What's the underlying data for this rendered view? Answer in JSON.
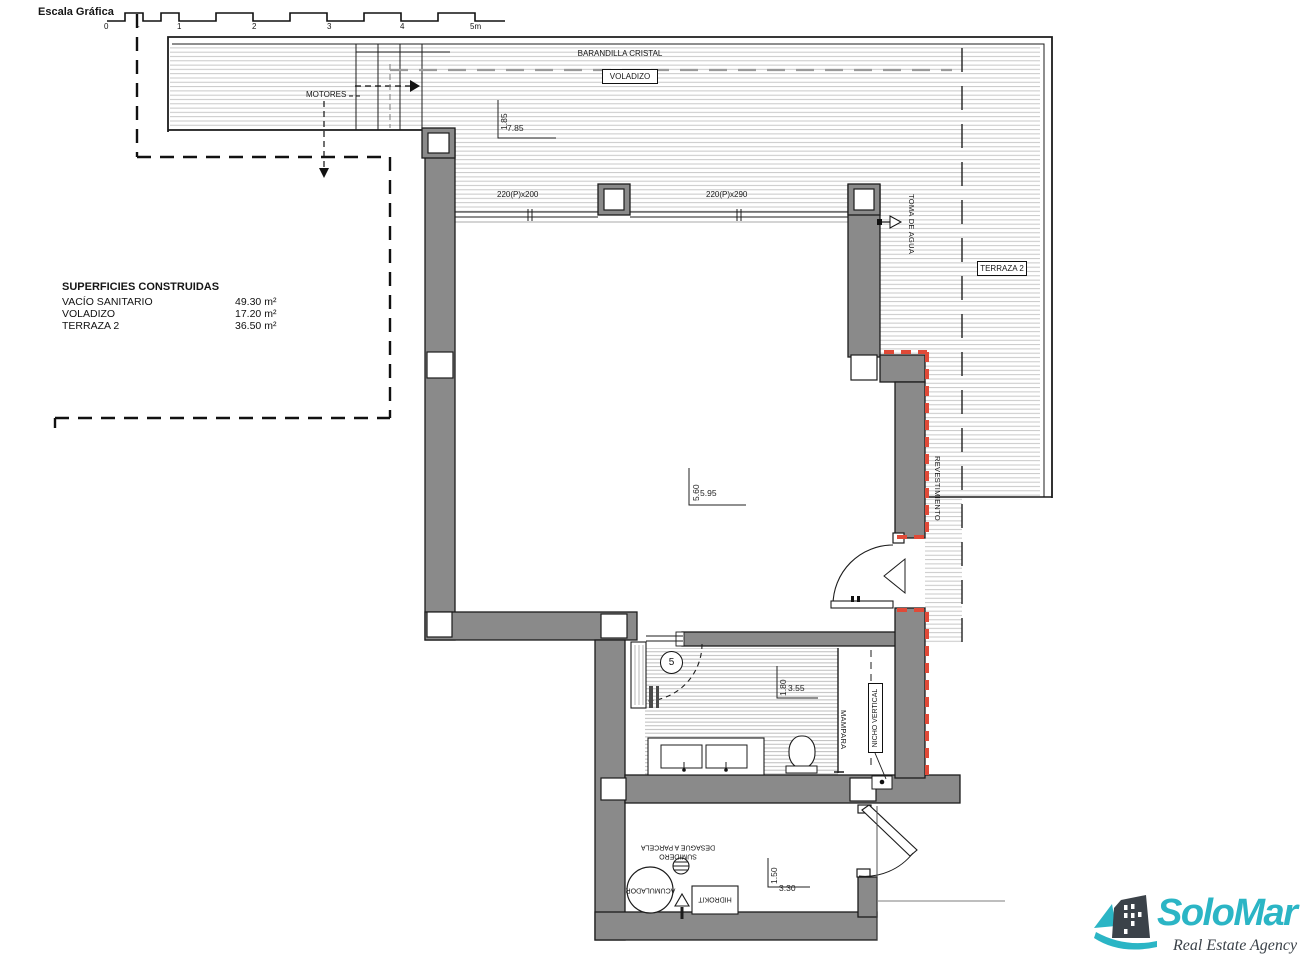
{
  "scale_bar": {
    "title": "Escala Gráfica",
    "ticks": [
      "0",
      "-",
      "1",
      "2",
      "3",
      "4",
      "5m"
    ]
  },
  "top_area": {
    "barandilla": "BARANDILLA CRISTAL",
    "voladizo": "VOLADIZO",
    "motores": "MOTORES",
    "dim_v": "1.85",
    "dim_h": "7.85",
    "window_left": "220(P)x200",
    "window_right": "220(P)x290",
    "toma_de_agua": "TOMA DE AGUA",
    "terraza": "TERRAZA 2"
  },
  "main_room": {
    "dim_v": "5.60",
    "dim_h": "5.95",
    "revestimiento": "REVESTIMIENTO"
  },
  "bathroom": {
    "number": "5",
    "dim_v": "1.80",
    "dim_h": "3.55",
    "mampara": "MAMPARA",
    "nicho": "NICHO VERTICAL"
  },
  "utility": {
    "dim_v": "1.50",
    "dim_h": "3.30",
    "sumidero_line1": "SUMIDERO",
    "sumidero_line2": "DESAGÜE A PARCELA",
    "acumulador": "ACUMULADOR",
    "hidrokit": "HIDROKIT"
  },
  "areas": {
    "title": "SUPERFICIES CONSTRUIDAS",
    "rows": [
      {
        "name": "VACÍO SANITARIO",
        "value": "49.30 m²"
      },
      {
        "name": "VOLADIZO",
        "value": "17.20 m²"
      },
      {
        "name": "TERRAZA 2",
        "value": "36.50 m²"
      }
    ]
  },
  "logo": {
    "name": "SoloMar",
    "tagline": "Real Estate Agency"
  },
  "colors": {
    "teal": "#2bb5c5",
    "dark": "#3b4249",
    "wall": "#8a8a8a",
    "cladding_red": "#e04a38",
    "hatch": "#c2c2c2"
  }
}
